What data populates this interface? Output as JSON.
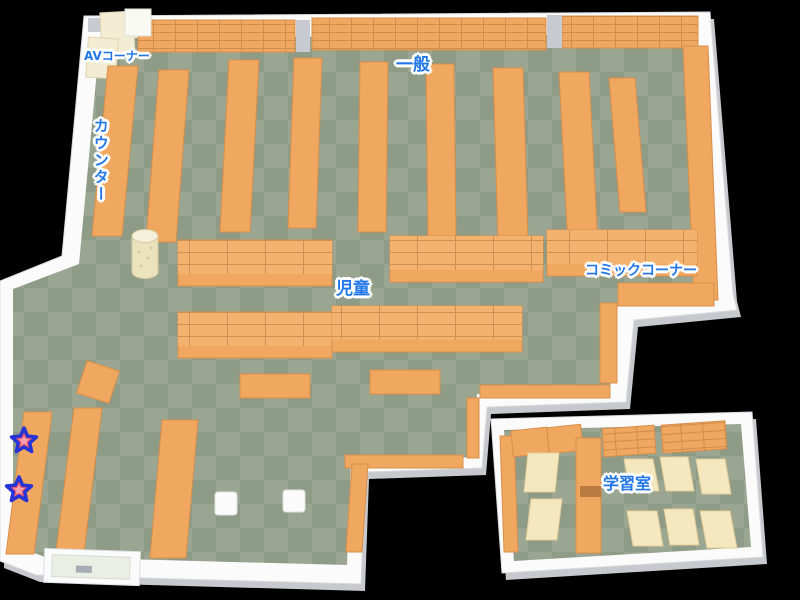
{
  "map": {
    "kind": "library floor map",
    "areas": [
      {
        "id": "av_corner",
        "label": "AVコーナー"
      },
      {
        "id": "counter",
        "label": "カウンター"
      },
      {
        "id": "general",
        "label": "一般"
      },
      {
        "id": "children",
        "label": "児童"
      },
      {
        "id": "comic_corner",
        "label": "コミックコーナー"
      },
      {
        "id": "study_room",
        "label": "学習室"
      }
    ],
    "markers": {
      "type": "star",
      "count": 2
    }
  },
  "colors": {
    "background": "#000000",
    "floor_light": "#9AA692",
    "floor_dark": "#8E9B86",
    "shelf": "#F0A75F",
    "shelf_top": "#F3B26E",
    "shelf_side": "#D98F4C",
    "shelf_grid": "#C9884A",
    "cream": "#F6E8BE",
    "cream_stroke": "#E2CC96",
    "av_cream": "#F3ECD2",
    "wall": "#FBFBFC",
    "wall_edge": "#D9DBDE",
    "wall_shadow": "#C6C9CD",
    "pillar": "#C7CAD0",
    "label": "#2277E8",
    "star_fill": "#F2596B",
    "star_inner": "#F9A0AC",
    "star_stroke": "#2633D6"
  }
}
